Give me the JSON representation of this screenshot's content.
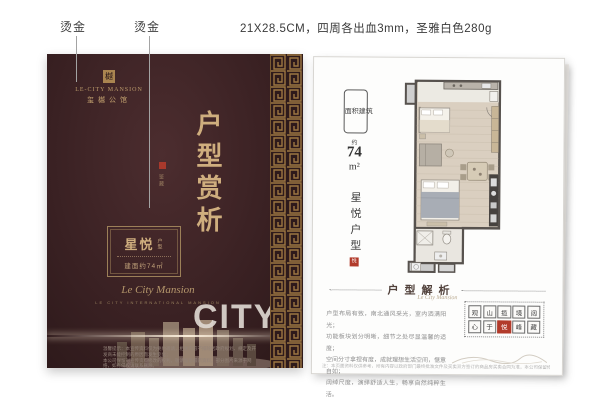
{
  "annotations": {
    "foil_label_left": "烫金",
    "foil_label_right": "烫金",
    "print_spec": "21X28.5CM，四周各出血3mm，圣雅白色280g"
  },
  "cover": {
    "logo": {
      "seal_char": "樾",
      "brand_en": "LE-CITY MANSION",
      "brand_cn": "玺樾公馆"
    },
    "main_title": "户型赏析",
    "title_note": "鉴藏",
    "unit_card": {
      "name": "星悦",
      "name_small": "户型",
      "area": "建面约74㎡"
    },
    "script": "Le City Mansion",
    "script_sub": "LE CITY INTERNATIONAL MANSION",
    "city_word": "CITYM",
    "fineprint_1": "温馨提示：本宣传资料仅为要约邀请，相关内容不排除因政府规划、规定及开发商未能控制的原因而发生变化；",
    "fineprint_2": "本公司保留对宣传资料修改的权利，敬请留意最新资料。部分图片来源于网络，如有侵权请联系删除。"
  },
  "page": {
    "area_stamp": {
      "chars": [
        "面",
        "积",
        "建",
        "筑"
      ],
      "approx": "约",
      "value": "74",
      "unit": "m²"
    },
    "unit_name_vertical": "星悦户型",
    "seal_char": "悦",
    "section": {
      "title": "户型解析",
      "script": "Le City Mansion",
      "paragraph": [
        "户型布局有致，南北通风采光，室内洒满阳光；",
        "功能板块划分明晰，细节之处尽显温馨的适度；",
        "空间分寸拿捏有度，成就理想生活空间，惬意自如；",
        "阔绰尺度，演绎舒适人生，畅享自然纯粹生活。"
      ],
      "seal_grid": [
        "观",
        "山",
        "揽",
        "境",
        "阔",
        "心",
        "于",
        "悦",
        "峰",
        "藏"
      ],
      "disclaimer": "注：本页面资料仅供参考，所有内容以政府部门最终批准文件及买卖双方签订的商品房买卖合同为准，本公司保留修改权利，敬请留意。"
    }
  },
  "colors": {
    "cover_bg": "#3a2123",
    "gold": "#cfae7e",
    "seal_red": "#b23b2b",
    "wall": "#57524e"
  }
}
